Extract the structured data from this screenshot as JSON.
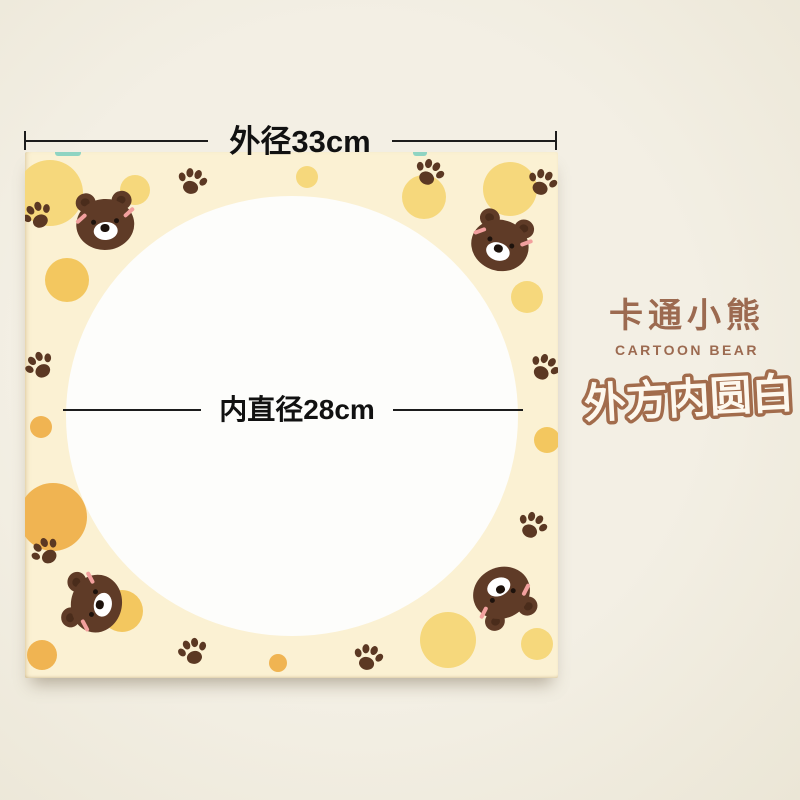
{
  "dimensions": {
    "outer_label": "外径33cm",
    "inner_label": "内直径28cm"
  },
  "side_text": {
    "title": "卡通小熊",
    "subtitle": "CARTOON BEAR",
    "tagline": "外方内圆白"
  },
  "palette": {
    "page_bg": "#f3efe4",
    "mat_bg": "#fbf1d3",
    "circle_white": "#fdfdfb",
    "line": "#1c1c1c",
    "dim_text": "#111111",
    "title_brown": "#9c6a50",
    "tagline_fill": "#fdf8ee",
    "tagline_stroke": "#a26c4c",
    "pale_yellow": "#f6d87c",
    "gold": "#f3c75f",
    "orange": "#f0b452",
    "bear_brown": "#5f3b27",
    "ear_inner": "#4a2c1b",
    "paw_brown": "#5b3823",
    "muzzle_white": "#ffffff",
    "nose_black": "#1d120c",
    "blush_pink": "#f2a09e",
    "teal": "#8fd4c2",
    "shadow": "rgba(110,95,70,0.45)"
  },
  "decorations": {
    "circles": [
      {
        "x": 25,
        "y": 41,
        "r": 33,
        "c": "pale_yellow"
      },
      {
        "x": 110,
        "y": 38,
        "r": 15,
        "c": "pale_yellow"
      },
      {
        "x": 282,
        "y": 25,
        "r": 11,
        "c": "pale_yellow"
      },
      {
        "x": 399,
        "y": 45,
        "r": 22,
        "c": "pale_yellow"
      },
      {
        "x": 485,
        "y": 37,
        "r": 27,
        "c": "pale_yellow"
      },
      {
        "x": 502,
        "y": 145,
        "r": 16,
        "c": "pale_yellow"
      },
      {
        "x": 42,
        "y": 128,
        "r": 22,
        "c": "gold"
      },
      {
        "x": 16,
        "y": 275,
        "r": 11,
        "c": "orange"
      },
      {
        "x": 522,
        "y": 288,
        "r": 13,
        "c": "gold"
      },
      {
        "x": 28,
        "y": 365,
        "r": 34,
        "c": "orange"
      },
      {
        "x": 97,
        "y": 459,
        "r": 21,
        "c": "gold"
      },
      {
        "x": 17,
        "y": 503,
        "r": 15,
        "c": "orange"
      },
      {
        "x": 253,
        "y": 511,
        "r": 9,
        "c": "orange"
      },
      {
        "x": 423,
        "y": 488,
        "r": 28,
        "c": "pale_yellow"
      },
      {
        "x": 512,
        "y": 492,
        "r": 16,
        "c": "pale_yellow"
      }
    ],
    "paws": [
      {
        "x": 13,
        "y": 64,
        "rot": -25
      },
      {
        "x": 167,
        "y": 30,
        "rot": 15
      },
      {
        "x": 404,
        "y": 21,
        "rot": 25
      },
      {
        "x": 517,
        "y": 31,
        "rot": 20
      },
      {
        "x": 15,
        "y": 214,
        "rot": -30
      },
      {
        "x": 519,
        "y": 216,
        "rot": 30
      },
      {
        "x": 21,
        "y": 400,
        "rot": -35
      },
      {
        "x": 168,
        "y": 500,
        "rot": -15
      },
      {
        "x": 343,
        "y": 506,
        "rot": 15
      },
      {
        "x": 507,
        "y": 374,
        "rot": 25
      }
    ],
    "bears": [
      {
        "x": 80,
        "y": 69,
        "rot": -4
      },
      {
        "x": 476,
        "y": 90,
        "rot": 18
      },
      {
        "x": 68,
        "y": 451,
        "rot": -80
      },
      {
        "x": 478,
        "y": 444,
        "rot": 155
      }
    ],
    "slivers": [
      {
        "x": 30,
        "y": 0,
        "w": 26,
        "h": 4
      },
      {
        "x": 388,
        "y": 0,
        "w": 14,
        "h": 4
      }
    ]
  }
}
